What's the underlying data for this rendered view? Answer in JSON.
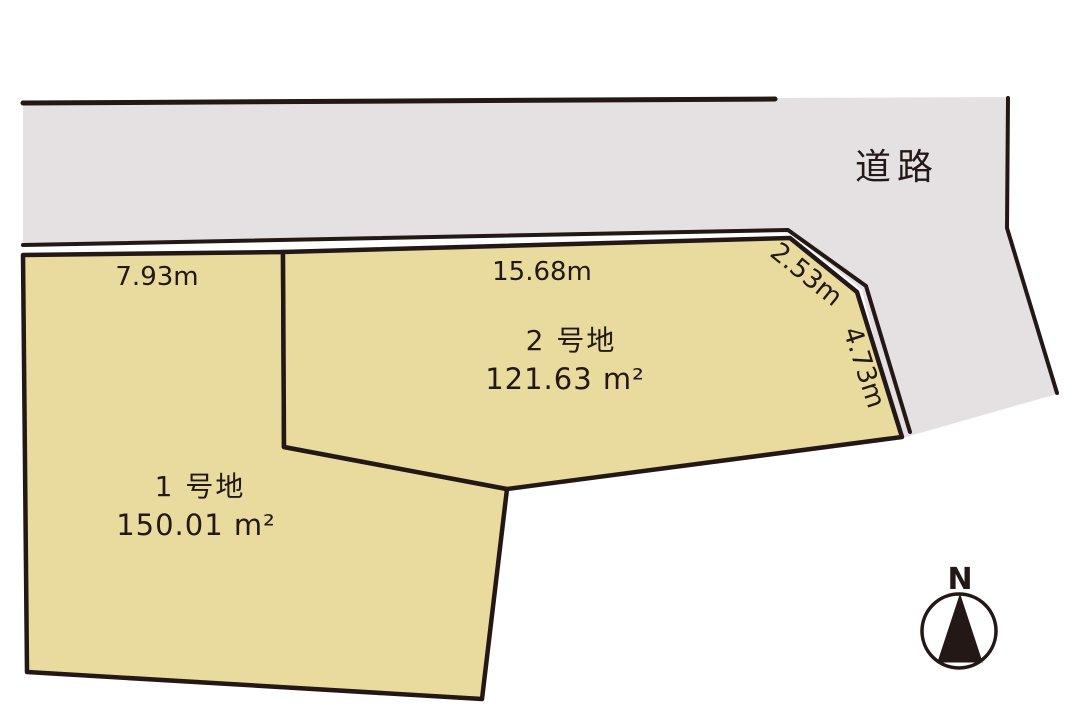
{
  "colors": {
    "line": "#231815",
    "road_fill": "#e5e1e2",
    "plot_fill": "#e8db9d",
    "background": "#ffffff"
  },
  "road": {
    "label": "道路"
  },
  "plots": [
    {
      "name": "1 号地",
      "area": "150.01 m²",
      "dimensions": [
        {
          "side": "top",
          "label": "7.93m"
        }
      ]
    },
    {
      "name": "2 号地",
      "area": "121.63 m²",
      "dimensions": [
        {
          "side": "top",
          "label": "15.68m"
        },
        {
          "side": "top-right-diagonal",
          "label": "2.53m"
        },
        {
          "side": "right",
          "label": "4.73m"
        }
      ]
    }
  ],
  "compass": {
    "label": "N"
  }
}
